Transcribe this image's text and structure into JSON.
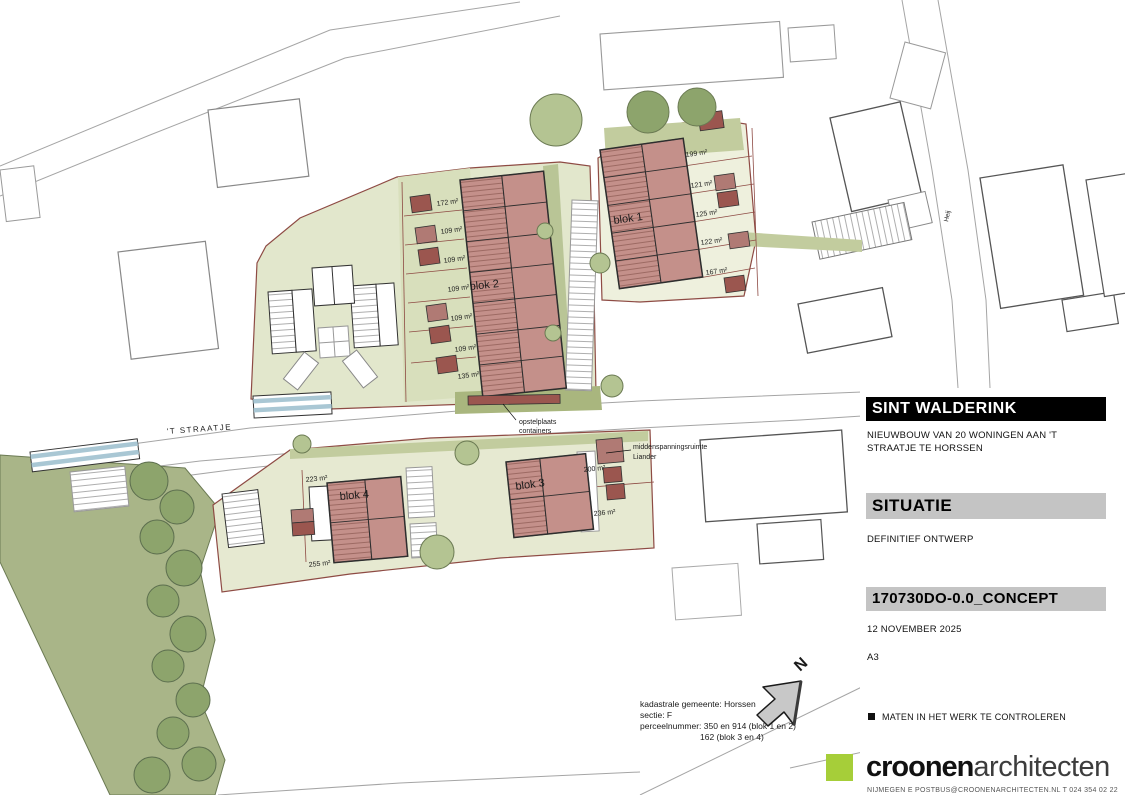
{
  "titleblock": {
    "project_title": "SINT WALDERINK",
    "project_description": "NIEUWBOUW VAN 20 WONINGEN AAN 'T STRAATJE TE HORSSEN",
    "sheet_title": "SITUATIE",
    "phase": "DEFINITIEF ONTWERP",
    "document_code": "170730DO-0.0_CONCEPT",
    "date": "12 NOVEMBER 2025",
    "paper_size": "A3",
    "note": "MATEN IN HET WERK TE CONTROLEREN",
    "logo_bold": "croonen",
    "logo_light": "architecten",
    "contact_line": "NIJMEGEN  E POSTBUS@CROONENARCHITECTEN.NL  T 024 354 02 22"
  },
  "plan": {
    "street_label": "'T STRAATJE",
    "side_street_label": "Heij",
    "north_letter": "N",
    "blok1": {
      "label": "blok 1",
      "areas": [
        "199 m²",
        "121 m²",
        "125 m²",
        "122 m²",
        "167 m²"
      ]
    },
    "blok2": {
      "label": "blok 2",
      "areas": [
        "172 m²",
        "109 m²",
        "109 m²",
        "109 m²",
        "109 m²",
        "109 m²",
        "135 m²"
      ]
    },
    "blok3": {
      "label": "blok 3",
      "areas": [
        "200 m²",
        "236 m²"
      ]
    },
    "blok4": {
      "label": "blok 4",
      "areas": [
        "223 m²",
        "255 m²"
      ]
    },
    "annotations": {
      "containers_line1": "opstelplaats",
      "containers_line2": "containers",
      "trafo_line1": "middenspanningsruimte",
      "trafo_line2": "Liander",
      "kadaster_line1": "kadastrale gemeente: Horssen",
      "kadaster_line2": "sectie: F",
      "kadaster_line3": "perceelnummer: 350 en 914 (blok 1 en 2)",
      "kadaster_line4": "162 (blok 3 en 4)"
    },
    "colors": {
      "building": "#c4908a",
      "building_hatch": "#9d6a63",
      "shed": "#9b564f",
      "parcel_boundary": "#8e4b44",
      "greenery": "#a9b588",
      "logo_green": "#a6ce39",
      "titlebar_gray": "#c4c4c4",
      "water_blue": "#a9c7d4"
    }
  }
}
